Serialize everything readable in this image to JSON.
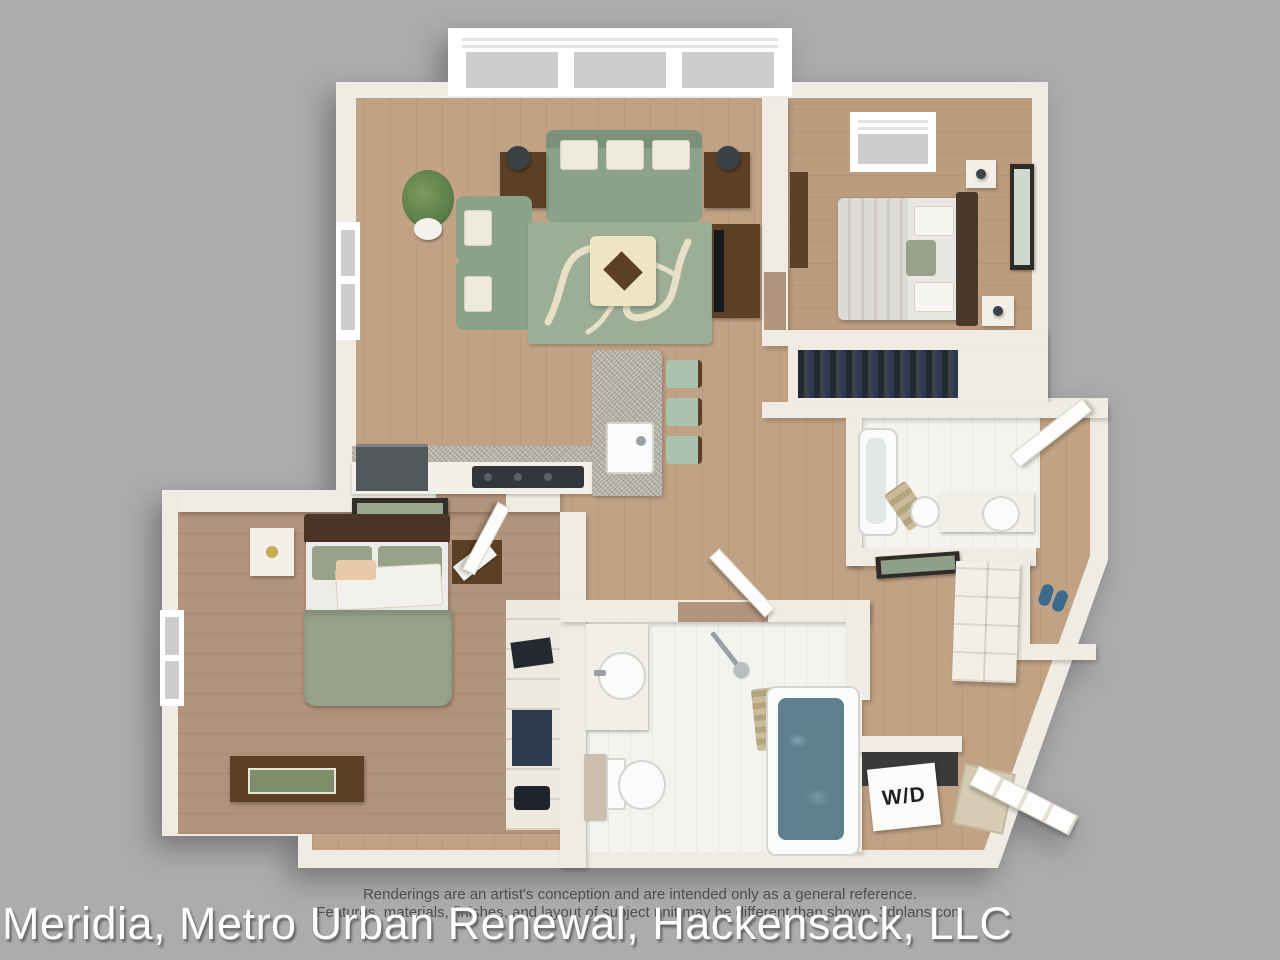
{
  "disclaimer": {
    "line1": "Renderings are an artist's conception and are intended only as a general reference.",
    "line2": "Features, materials, finishes, and layout of subject unit may be different than shown. 3dplans.com"
  },
  "watermark": {
    "text": "Meridia, Metro Urban Renewal, Hackensack, LLC"
  },
  "labels": {
    "washer_dryer": "W/D"
  },
  "colors": {
    "bg": "#acacae",
    "wall": "#f0ece3",
    "wood": "#c1a284",
    "wood_dark": "#b2937b",
    "wood_bed1": "#bc9c7e",
    "tile": "#f3f3f0",
    "sage": "#8aa287",
    "stool": "#a9c3ae",
    "rug": "#9dae97",
    "rug_cream": "#e7e0c6",
    "granite": "#b7b3a9",
    "wood_furn": "#5c4026",
    "charcoal": "#3c4146",
    "water": "#5e8191",
    "plant_green": "#5e7f4a",
    "duvet_sage": "#97a289",
    "slipper_blue": "#3a6b8f"
  }
}
